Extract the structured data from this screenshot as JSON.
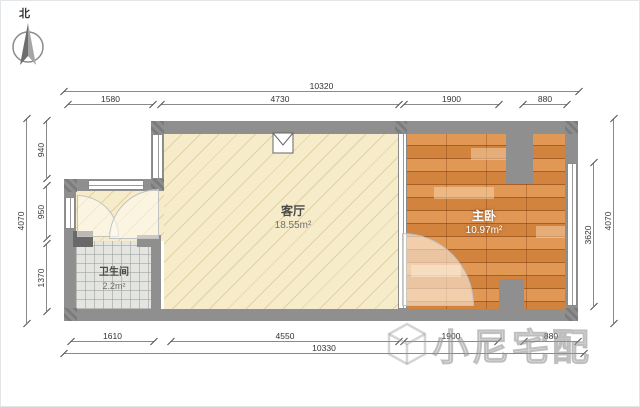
{
  "north": {
    "label": "北"
  },
  "rooms": {
    "living": {
      "name": "客厅",
      "area": "18.55m²"
    },
    "bedroom": {
      "name": "主卧",
      "area": "10.97m²"
    },
    "bathroom": {
      "name": "卫生间",
      "area": "2.2m²"
    }
  },
  "dimensions": {
    "top": {
      "overall": "10320",
      "segments": [
        "1580",
        "4730",
        "1900",
        "880"
      ]
    },
    "bottom": {
      "overall": "10330",
      "segments": [
        "1610",
        "4550",
        "1900",
        "880"
      ]
    },
    "left": {
      "overall": "4070",
      "segments": [
        "940",
        "950",
        "1370"
      ]
    },
    "right": {
      "overall": "4070",
      "inner": "3620"
    }
  },
  "watermark": {
    "text": "小尼宅配"
  },
  "colors": {
    "wall": "#8f8f8f",
    "living_floor": "#f6ecc9",
    "wood_floor": "#df8c42",
    "tile_floor": "#e4e5e1"
  }
}
